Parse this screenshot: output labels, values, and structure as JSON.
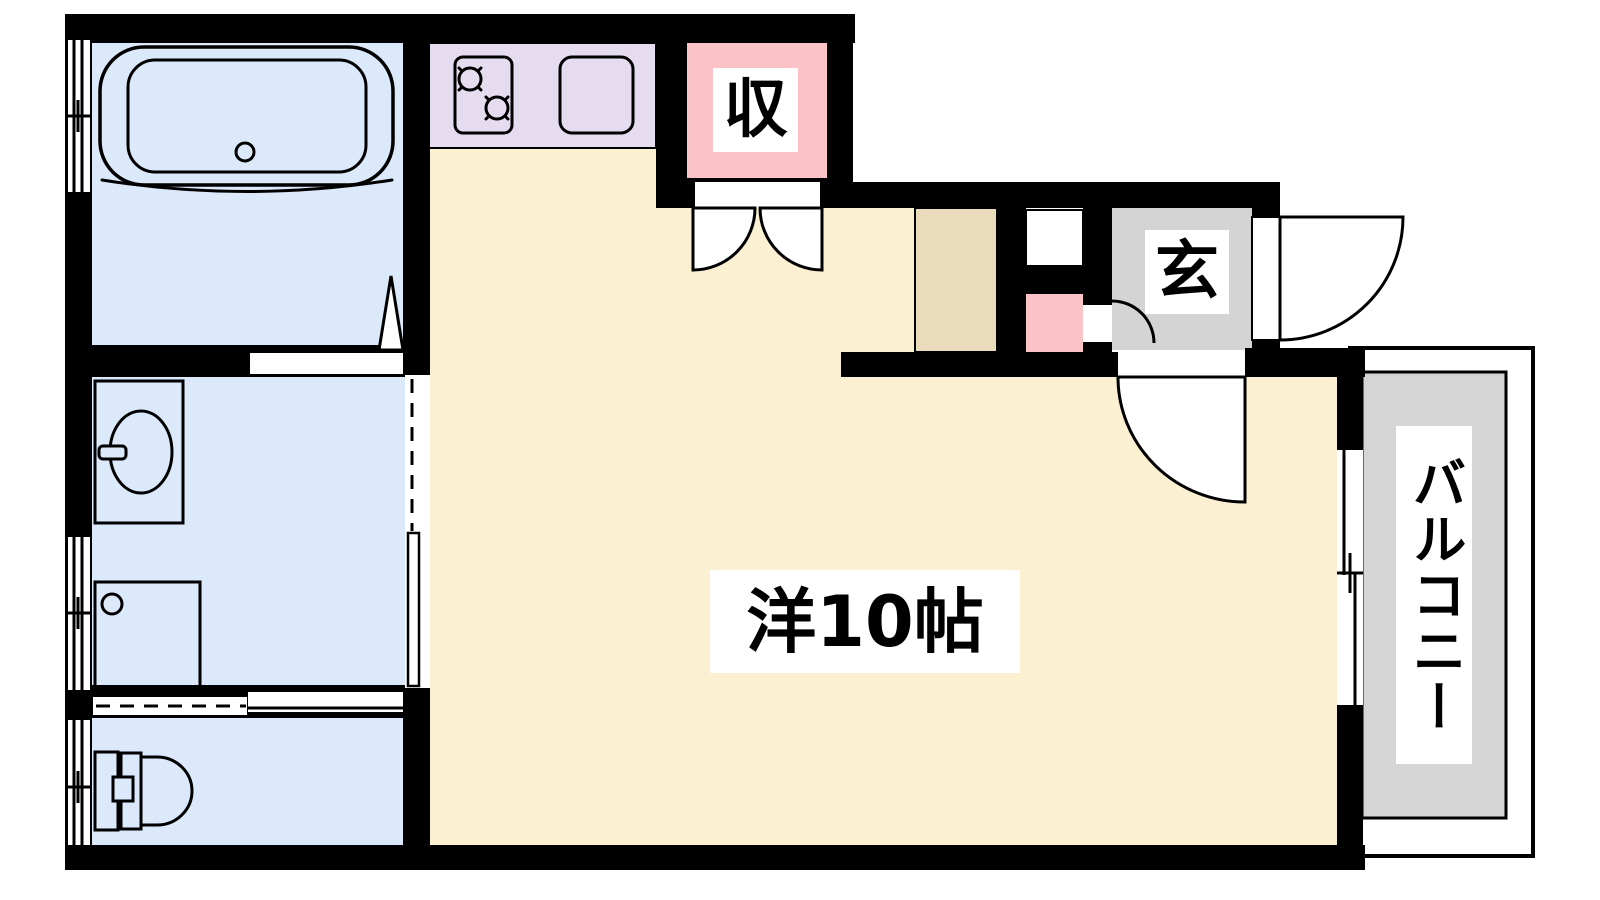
{
  "floorplan": {
    "title": "apartment-floorplan",
    "labels": {
      "main_room": "洋10帖",
      "closet": "収",
      "entrance": "玄",
      "balcony": "バルコニー"
    },
    "colors": {
      "wall": "#000000",
      "line": "#000000",
      "opening": "#ffffff",
      "background": "#ffffff",
      "main_room": "#fcf0d2",
      "wet_rooms": "#dbe9fa",
      "kitchen_counter": "#e5dcf0",
      "closet": "#fbc3c8",
      "hall_nook": "#fbc3c8",
      "entrance": "#d4d4d4",
      "balcony": "#d5d5d5",
      "hall_cabinet": "#eadbbc",
      "label_text": "#000000"
    }
  }
}
